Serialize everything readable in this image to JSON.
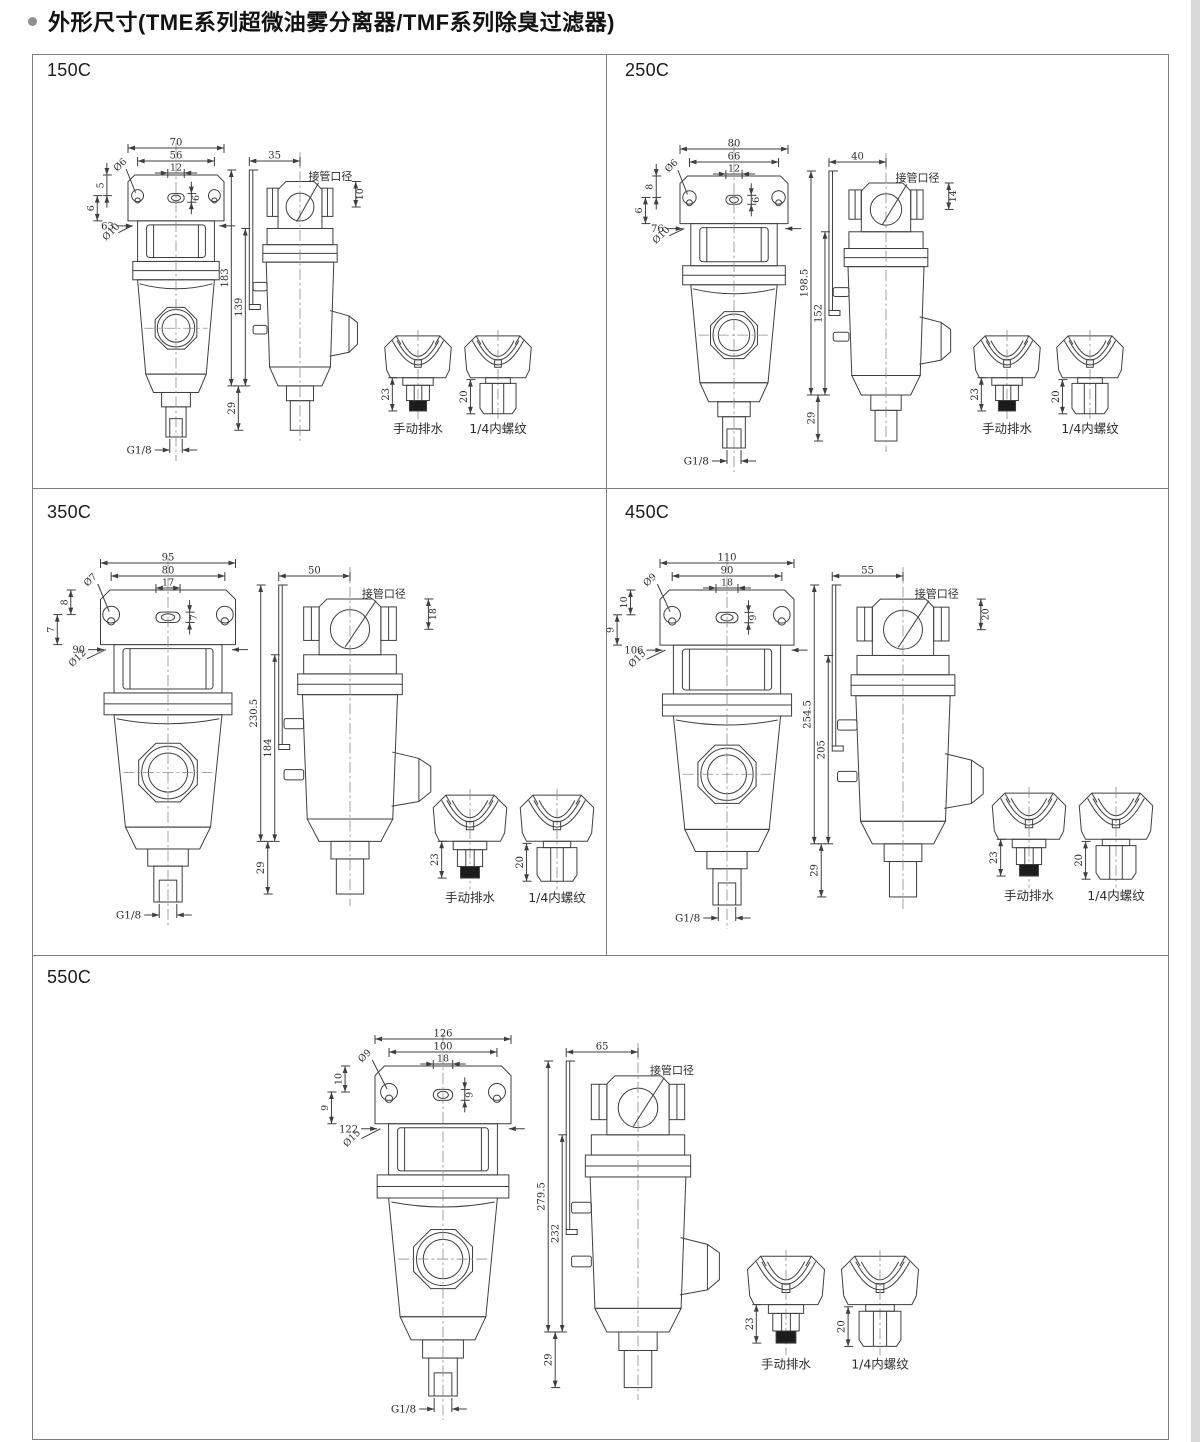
{
  "page": {
    "title": "外形尺寸(TME系列超微油雾分离器/TMF系列除臭过滤器)"
  },
  "common": {
    "port_label": "接管口径",
    "drain_caption": "手动排水",
    "thread_caption": "1/4内螺纹",
    "drain_dim": "23",
    "thread_dim": "20",
    "drain_thread": "G1/8"
  },
  "panels": [
    {
      "id": "150c",
      "label": "150C",
      "front": {
        "w1": "70",
        "w2": "56",
        "slot_w": "12",
        "slot_h": "6",
        "ear_hole": "Ø6",
        "off1": "5",
        "off2": "6",
        "lug_hole": "Ø10",
        "body_w": "63"
      },
      "side": {
        "bracket_w": "35",
        "port_dim": "10",
        "h_total": "183",
        "h_body": "139",
        "h_drain": "29"
      }
    },
    {
      "id": "250c",
      "label": "250C",
      "front": {
        "w1": "80",
        "w2": "66",
        "slot_w": "12",
        "slot_h": "6",
        "ear_hole": "Ø6",
        "off1": "8",
        "off2": "6",
        "lug_hole": "Ø10",
        "body_w": "76"
      },
      "side": {
        "bracket_w": "40",
        "port_dim": "14",
        "h_total": "198.5",
        "h_body": "152",
        "h_drain": "29"
      }
    },
    {
      "id": "350c",
      "label": "350C",
      "front": {
        "w1": "95",
        "w2": "80",
        "slot_w": "17",
        "slot_h": "7",
        "ear_hole": "Ø7",
        "off1": "8",
        "off2": "7",
        "lug_hole": "Ø12",
        "body_w": "90"
      },
      "side": {
        "bracket_w": "50",
        "port_dim": "18",
        "h_total": "230.5",
        "h_body": "184",
        "h_drain": "29"
      }
    },
    {
      "id": "450c",
      "label": "450C",
      "front": {
        "w1": "110",
        "w2": "90",
        "slot_w": "18",
        "slot_h": "9",
        "ear_hole": "Ø9",
        "off1": "10",
        "off2": "9",
        "lug_hole": "Ø15",
        "body_w": "106"
      },
      "side": {
        "bracket_w": "55",
        "port_dim": "20",
        "h_total": "254.5",
        "h_body": "205",
        "h_drain": "29"
      }
    },
    {
      "id": "550c",
      "label": "550C",
      "front": {
        "w1": "126",
        "w2": "100",
        "slot_w": "18",
        "slot_h": "9",
        "ear_hole": "Ø9",
        "off1": "10",
        "off2": "9",
        "lug_hole": "Ø15",
        "body_w": "122"
      },
      "side": {
        "bracket_w": "65",
        "port_dim": null,
        "h_total": "279.5",
        "h_body": "232",
        "h_drain": "29"
      }
    }
  ]
}
